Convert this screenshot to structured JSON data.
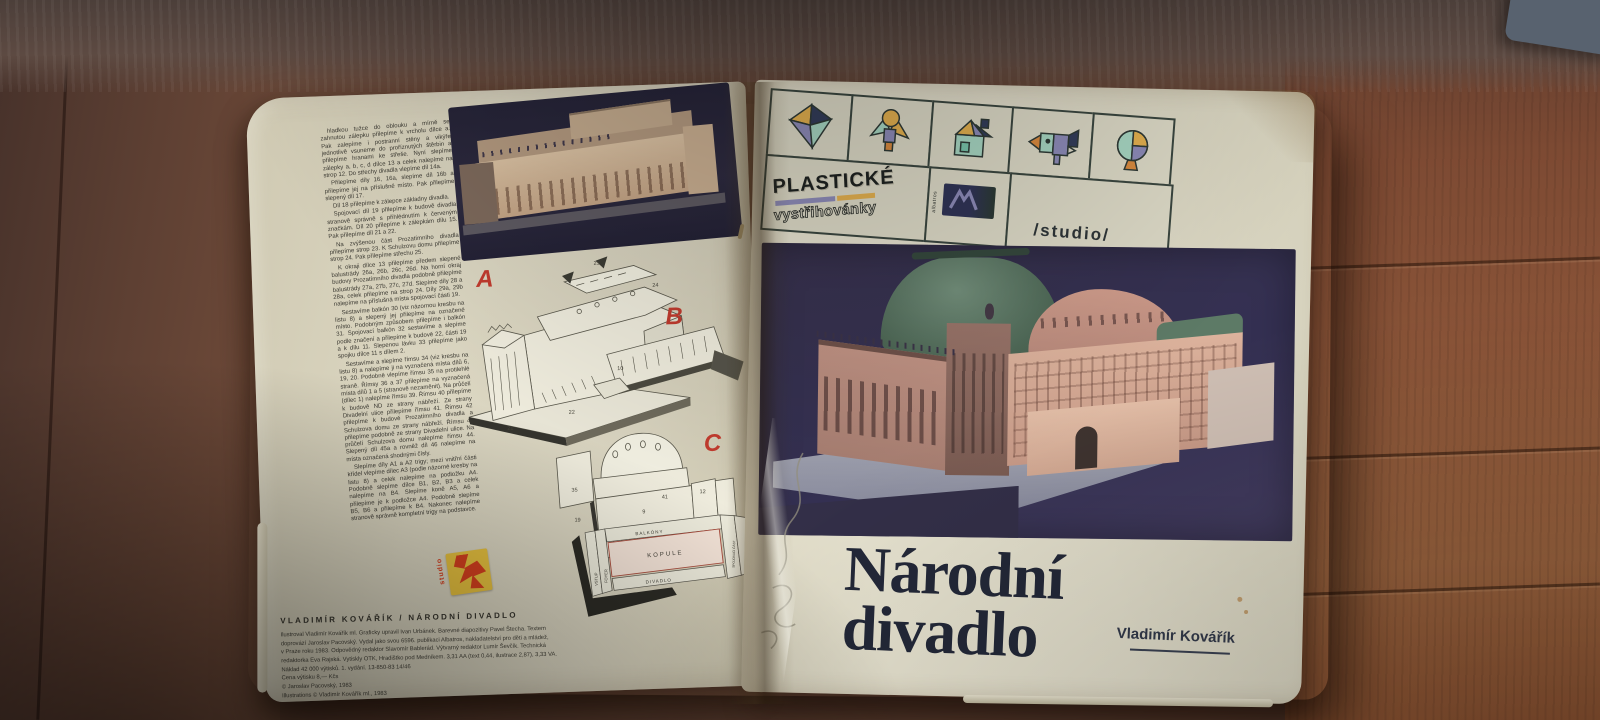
{
  "colors": {
    "accent_red": "#c23b2e",
    "brand_purple": "#8d8bb8",
    "brand_orange": "#e3b04f",
    "brand_navy": "#333d5a",
    "brand_teal": "#a7d6c2",
    "page_cream": "#ddd9c6",
    "photo_background": "#37324e",
    "title_ink": "#232838",
    "wood_brown": "#7a4e3b",
    "stamp_yellow": "#e8c23f",
    "stamp_red": "#d6401f"
  },
  "left_page": {
    "instructions": [
      "hladkou tužce do oblouku a mírně se zahnutou zálepku přilepíme k vrcholu dílce a. Pak zalepíme i postranní stěny a vikýře jednotlivě vsuneme do proříznutých štěrbin a přilepíme hranami ke střeše. Nyní slepíme zálepky a, b, c, d dílce 13 a celek nalepíme na strop 12. Do střechy divadla vlepíme díl 14a.",
      "Přilepíme díly 16, 16a, slepíme díl 16b a přilepíme jej na příslušné místo. Pak přilepíme slepený díl 17.",
      "Díl 18 přilepíme k zálepce základny divadla.",
      "Spojovací díl 19 přilepíme k budově divadla stranově správně s přihlédnutím k červeným značkám. Díl 20 přilepíme k zálepkám dílu 15. Pak přilepíme díl 21 a 22.",
      "Na zvýšenou část Prozatímního divadla přilepíme strop 23. K Schulzovu domu přilepíme strop 24. Pak přilepíme střechu 25.",
      "K okraji dílce 13 přilepíme předem slepené balustrády 26a, 26b, 26c, 26d. Na horní okraj budovy Prozatímního divadla podobně přilepíme balustrády 27a, 27b, 27c, 27d. Slepíme díly 28 a 28a, celek přilepíme na strop 24. Díly 29a, 29b nalepíme na příslušná místa spojovací části 19.",
      "Sestavíme balkón 30 (viz názornou kresbu na listu 8) a slepený jej přilepíme na označené místo. Podobným způsobem přilepíme i balkón 31. Spojovací balkón 32 sestavíme a slepíme podle značení a přilepíme k budově 22, části 19 a k dílu 11. Slepenou lávku 33 přilepíme jako spojku dílce 11 s dílem 2.",
      "Sestavíme a slepíme římsu 34 (viz kresbu na listu 8) a nalepíme ji na vyznačená místa dílů 6, 19, 20. Podobně vlepíme římsu 35 na protilehlé straně. Římsy 36 a 37 přilepíme na vyznačená místa dílů 1 a 5 (stranově nezaměnit). Na průčelí (dílec 1) nalepíme římsu 39. Římsu 40 přilepíme k budově ND ze strany nábřeží. Ze strany Divadelní ulice přilepíme římsu 41. Římsu 42 přilepíme k budově Prozatímního divadla a Schulzova domu ze strany nábřeží. Římsu 43 přilepíme podobně ze strany Divadelní ulice. Na průčelí Schulzova domu nalepíme římsu 44. Slepený díl 45a a rovněž díl 46 nalepíme na místa označená shodnými čísly.",
      "Slepíme díly A1 a A2 trigy; mezi vnitřní části křídel vlepíme dílec A3 (podle názorné kresby na listu 8) a celek nalepíme na podložku A4. Podobně slepíme dílce B1, B2, B3 a celek nalepíme na B4. Slepíme koně A5, A6 a přilepíme je k podložce A4. Podobně slepíme B5, B6 a přilepíme k B4. Nakonec nalepíme stranově správně kompletní trigy na podstavce."
    ],
    "diagram_letters": [
      "A",
      "B",
      "C"
    ],
    "part_numbers": [
      "23",
      "24",
      "10",
      "21",
      "22",
      "9",
      "41",
      "12",
      "35",
      "19"
    ],
    "plan": {
      "top_label": "BALKÓNY",
      "center_label": "KOPULE",
      "bottom_label": "DIVADLO",
      "left_labels": [
        "VSTUP",
        "FOYER"
      ],
      "right_labels": [
        "SPOJOVACÍ ČÁST",
        "PROZATÍMNÍ DIVADLO",
        "SCHULZŮV DŮM"
      ]
    },
    "stamp_text": "studio",
    "credits_title": "VLADIMÍR KOVÁŘÍK / NÁRODNÍ DIVADLO",
    "credits": [
      "Ilustroval Vladimír Kovářík ml. Graficky upravil Ivan Urbánek. Barevné diapozitivy Pavel Štecha. Textem",
      "doprovází Jaroslav Pacovský. Vydal jako svou 6596. publikaci Albatros, nakladatelství pro děti a mládež,",
      "v Praze roku 1983. Odpovědný redaktor Slavomír Bablerád. Výtvarný redaktor Lumír Ševčík. Technická",
      "redaktorka Eva Rajská. Vytiskly OTK, Hradištko pod Medníkem. 3,31 AA (text 0,44, ilustrace 2,87), 3,33 VA.",
      "Náklad 42 000 výtisků. 1. vydání. 13-850-83 14/46",
      "Cena výtisku 8,— Kčs",
      "© Jaroslav Pacovský, 1983",
      "Illustrations © Vladimír Kovářík ml., 1983"
    ]
  },
  "right_page": {
    "logo_icons": [
      "gem",
      "figure",
      "house",
      "bird",
      "balloon-tree"
    ],
    "brand_top": "PLASTICKÉ",
    "brand_bottom": "vystřihovánky",
    "publisher": "albatros",
    "studio_label": "/studio/",
    "title": [
      "Národní",
      "divadlo"
    ],
    "author": "Vladimír Kovářík"
  }
}
